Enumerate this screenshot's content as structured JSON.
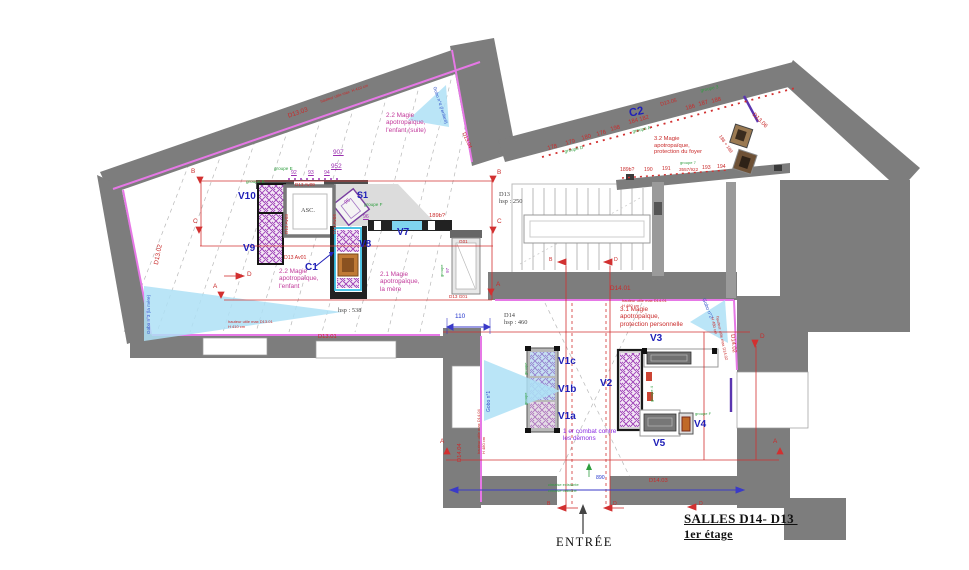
{
  "colors": {
    "wall_gray": "#7d7d7d",
    "light_wall_gray": "#9a9a9a",
    "cimaise_pink": "#e678e6",
    "cimaise_purple": "#5a35b0",
    "annotation_red": "#c92a2a",
    "theme_magenta": "#c2399b",
    "object_purple": "#9b30b0",
    "vitrine_blue": "#2020b8",
    "group_green": "#2e9e3e",
    "gobo_lightblue": "#aee0f6",
    "dimension_blue": "#2233cc"
  },
  "icons": {
    "entrance_arrow": "up-arrow-icon",
    "section_markers": "red-section-arrow-icons",
    "gobos": "light-projection-triangle-icons"
  },
  "annotations": [
    {
      "n": "wall-id-d13-03",
      "t": "D13.03",
      "x": 287,
      "y": 113,
      "c": "red s6",
      "r": -19
    },
    {
      "n": "wall-note-d13-03",
      "t": "hauteur utile max  H 410 cm",
      "x": 320,
      "y": 100,
      "c": "red s3",
      "r": -19
    },
    {
      "n": "gobo4-label",
      "t": "Gobo n°4 (l'enfant)",
      "x": 437,
      "y": 86,
      "c": "blu s4",
      "r": 72
    },
    {
      "n": "wall-id-d13-04",
      "t": "D13.04",
      "x": 465,
      "y": 132,
      "c": "red s5",
      "r": 66
    },
    {
      "n": "theme-2-2-suite",
      "t": "2.2 Magie\napotropaïque,\nl'enfant (suite)",
      "x": 386,
      "y": 112,
      "c": "mag s6"
    },
    {
      "n": "object-num-907",
      "t": "907",
      "x": 333,
      "y": 149,
      "c": "pur s6 u"
    },
    {
      "n": "object-num-952",
      "t": "952",
      "x": 331,
      "y": 163,
      "c": "pur s6 u"
    },
    {
      "n": "object-num-92",
      "t": "92",
      "x": 291,
      "y": 171,
      "c": "pur s5 u"
    },
    {
      "n": "object-num-93",
      "t": "93",
      "x": 308,
      "y": 171,
      "c": "pur s5 u"
    },
    {
      "n": "object-num-94",
      "t": "94",
      "x": 324,
      "y": 171,
      "c": "pur s5 u"
    },
    {
      "n": "group-label-e",
      "t": "groupe E",
      "x": 274,
      "y": 166,
      "c": "grn s4"
    },
    {
      "n": "group-label-b",
      "t": "groupe B",
      "x": 246,
      "y": 179,
      "c": "grn s4"
    },
    {
      "n": "vitrine-v10",
      "t": "V10",
      "x": 238,
      "y": 191,
      "c": "vb s10"
    },
    {
      "n": "wall-id-d13-av09",
      "t": "D13 Av09",
      "x": 295,
      "y": 182,
      "c": "red s4"
    },
    {
      "n": "wall-id-d13-av03",
      "t": "D13 Av03",
      "x": 284,
      "y": 234,
      "c": "red s4",
      "r": -90
    },
    {
      "n": "wall-id-d13-av04",
      "t": "D13 Av04",
      "x": 332,
      "y": 234,
      "c": "red s4",
      "r": -90
    },
    {
      "n": "elevator-label",
      "t": "ASC.",
      "x": 301,
      "y": 207,
      "c": "dim s6"
    },
    {
      "n": "vitrine-s1",
      "t": "S1",
      "x": 357,
      "y": 190,
      "c": "vb s9"
    },
    {
      "n": "object-num-95",
      "t": "95",
      "x": 344,
      "y": 202,
      "c": "pur s5",
      "r": -40
    },
    {
      "n": "group-label-f1",
      "t": "groupe F",
      "x": 364,
      "y": 202,
      "c": "grn s4"
    },
    {
      "n": "object-num-96",
      "t": "96",
      "x": 363,
      "y": 215,
      "c": "pur s5 u"
    },
    {
      "n": "object-num-189b-left",
      "t": "189b?",
      "x": 429,
      "y": 213,
      "c": "red s55"
    },
    {
      "n": "vitrine-v7",
      "t": "V7",
      "x": 397,
      "y": 227,
      "c": "vb s10"
    },
    {
      "n": "vitrine-v8",
      "t": "V8",
      "x": 359,
      "y": 239,
      "c": "vb s10"
    },
    {
      "n": "vitrine-c1",
      "t": "C1",
      "x": 305,
      "y": 262,
      "c": "vb s10"
    },
    {
      "n": "vitrine-v9",
      "t": "V9",
      "x": 243,
      "y": 243,
      "c": "vb s10"
    },
    {
      "n": "wall-id-d13-av01",
      "t": "D13 Av01",
      "x": 284,
      "y": 256,
      "c": "red s5"
    },
    {
      "n": "theme-2-2",
      "t": "2.2 Magie\napotropaïque,\nl'enfant",
      "x": 279,
      "y": 268,
      "c": "mag s6"
    },
    {
      "n": "theme-2-1",
      "t": "2.1 Magie\napotropaïque,\nla mère",
      "x": 380,
      "y": 271,
      "c": "mag s6"
    },
    {
      "n": "wall-id-d13-02",
      "t": "D13.02",
      "x": 153,
      "y": 264,
      "c": "red s6",
      "r": -79
    },
    {
      "n": "gobo3-label",
      "t": "Gobo n°3 (la mère)",
      "x": 146,
      "y": 334,
      "c": "blu s4",
      "r": -90
    },
    {
      "n": "wall-note-d13-01",
      "t": "hauteur utile max D13.01\nH 410 cm",
      "x": 228,
      "y": 320,
      "c": "red s3"
    },
    {
      "n": "wall-id-d13-01",
      "t": "D13.01",
      "x": 318,
      "y": 334,
      "c": "red s55"
    },
    {
      "n": "dim-hsp-538",
      "t": "hsp : 538",
      "x": 338,
      "y": 307,
      "c": "dim s6"
    },
    {
      "n": "vitrine-g01-tag",
      "t": "G01",
      "x": 459,
      "y": 239,
      "c": "red s4"
    },
    {
      "n": "wall-id-d13-g01",
      "t": "D13 G01",
      "x": 449,
      "y": 294,
      "c": "red s4"
    },
    {
      "n": "object-num-97",
      "t": "97",
      "x": 445,
      "y": 273,
      "c": "pur s4",
      "r": -90
    },
    {
      "n": "group-label-g01",
      "t": "groupe",
      "x": 440,
      "y": 277,
      "c": "grn s3",
      "r": -90
    },
    {
      "n": "section-b-left",
      "t": "B",
      "x": 191,
      "y": 168,
      "c": "red s6"
    },
    {
      "n": "section-b-right",
      "t": "B",
      "x": 497,
      "y": 169,
      "c": "red s6"
    },
    {
      "n": "section-c-left",
      "t": "C",
      "x": 193,
      "y": 218,
      "c": "red s6"
    },
    {
      "n": "section-c-right",
      "t": "C",
      "x": 497,
      "y": 218,
      "c": "red s6"
    },
    {
      "n": "section-a-left",
      "t": "A",
      "x": 213,
      "y": 283,
      "c": "red s6"
    },
    {
      "n": "section-a-right",
      "t": "A",
      "x": 496,
      "y": 281,
      "c": "red s6"
    },
    {
      "n": "section-d-mid",
      "t": "D",
      "x": 247,
      "y": 271,
      "c": "red s6"
    },
    {
      "n": "room-c2",
      "t": "C2",
      "x": 628,
      "y": 108,
      "c": "vb s11",
      "r": -12
    },
    {
      "n": "object-num-178",
      "t": "178",
      "x": 547,
      "y": 146,
      "c": "red s55",
      "r": -15
    },
    {
      "n": "object-num-179",
      "t": "179",
      "x": 565,
      "y": 141,
      "c": "red s55",
      "r": -15
    },
    {
      "n": "object-num-180",
      "t": "180",
      "x": 581,
      "y": 136,
      "c": "red s55",
      "r": -15
    },
    {
      "n": "object-num-176",
      "t": "176",
      "x": 596,
      "y": 132,
      "c": "red s55",
      "r": -15
    },
    {
      "n": "object-num-198",
      "t": "198",
      "x": 610,
      "y": 127,
      "c": "red s55",
      "r": -15
    },
    {
      "n": "object-num-184-182",
      "t": "184 182",
      "x": 628,
      "y": 120,
      "c": "red s55",
      "r": -15
    },
    {
      "n": "wall-id-d13-05",
      "t": "D13.05",
      "x": 660,
      "y": 103,
      "c": "red s5",
      "r": -15
    },
    {
      "n": "object-num-186",
      "t": "186",
      "x": 685,
      "y": 106,
      "c": "red s55",
      "r": -15
    },
    {
      "n": "object-num-187",
      "t": "187",
      "x": 698,
      "y": 102,
      "c": "red s55",
      "r": -15
    },
    {
      "n": "object-num-188",
      "t": "188",
      "x": 711,
      "y": 99,
      "c": "red s55",
      "r": -15
    },
    {
      "n": "group-label-d",
      "t": "groupe D",
      "x": 564,
      "y": 149,
      "c": "grn s4",
      "r": -13
    },
    {
      "n": "group-label-a",
      "t": "groupe A",
      "x": 632,
      "y": 129,
      "c": "grn s4",
      "r": -13
    },
    {
      "n": "group-label-3",
      "t": "groupe 3",
      "x": 700,
      "y": 88,
      "c": "grn s4",
      "r": -12
    },
    {
      "n": "theme-3-2",
      "t": "3.2 Magie\napotropaïque,\nprotection du foyer",
      "x": 654,
      "y": 136,
      "c": "red s55"
    },
    {
      "n": "object-num-189b",
      "t": "189b?",
      "x": 620,
      "y": 168,
      "c": "red s5"
    },
    {
      "n": "object-num-190",
      "t": "190",
      "x": 644,
      "y": 168,
      "c": "red s5"
    },
    {
      "n": "object-num-191",
      "t": "191",
      "x": 662,
      "y": 167,
      "c": "red s5"
    },
    {
      "n": "object-num-3557-922",
      "t": "3557/922",
      "x": 679,
      "y": 167,
      "c": "red s4"
    },
    {
      "n": "object-num-193",
      "t": "193",
      "x": 702,
      "y": 166,
      "c": "red s5"
    },
    {
      "n": "object-num-194",
      "t": "194",
      "x": 717,
      "y": 165,
      "c": "red s5"
    },
    {
      "n": "group-label-7",
      "t": "groupe 7",
      "x": 680,
      "y": 161,
      "c": "grn s3"
    },
    {
      "n": "object-num-188-189",
      "t": "188 + 189",
      "x": 722,
      "y": 134,
      "c": "red s4",
      "r": 55
    },
    {
      "n": "wall-id-d13-06",
      "t": "D13.06",
      "x": 755,
      "y": 112,
      "c": "red s55",
      "r": 45
    },
    {
      "n": "room-d13-stairs",
      "t": "D13\nhsp : 250",
      "x": 499,
      "y": 191,
      "c": "dim s6"
    },
    {
      "n": "section-b-stairs",
      "t": "B",
      "x": 549,
      "y": 258,
      "c": "red s5"
    },
    {
      "n": "section-d-stairs",
      "t": "D",
      "x": 614,
      "y": 258,
      "c": "red s5"
    },
    {
      "n": "wall-id-d14-01",
      "t": "D14.01",
      "x": 610,
      "y": 285,
      "c": "red s6"
    },
    {
      "n": "wall-note-d14-01",
      "t": "hauteur utile max D14.01\nH 480 cm",
      "x": 622,
      "y": 299,
      "c": "red s3"
    },
    {
      "n": "room-d14",
      "t": "D14\nhsp : 460",
      "x": 504,
      "y": 312,
      "c": "dim s6"
    },
    {
      "n": "dim-110",
      "t": "110",
      "x": 455,
      "y": 313,
      "c": "bl2 s6"
    },
    {
      "n": "gobo1-label",
      "t": "Gobo n°1",
      "x": 487,
      "y": 412,
      "c": "blu s45",
      "r": -90
    },
    {
      "n": "wall-id-d14-04",
      "t": "D14.04",
      "x": 457,
      "y": 462,
      "c": "red s55",
      "r": -90
    },
    {
      "n": "wall-note-d14-04",
      "t": "hauteur utile max D14.04\nH 480 cm",
      "x": 477,
      "y": 454,
      "c": "red s3",
      "r": -90
    },
    {
      "n": "theme-3-1",
      "t": "3.1 Magie\napotropaïque,\nprotection personnelle",
      "x": 620,
      "y": 306,
      "c": "red s6"
    },
    {
      "n": "gobo2-label",
      "t": "Gobo n°2",
      "x": 705,
      "y": 298,
      "c": "blu s45",
      "r": 68
    },
    {
      "n": "wall-note-d14-02",
      "t": "hauteur utile max D14.02\nH 480 cm",
      "x": 719,
      "y": 316,
      "c": "red s3",
      "r": 78
    },
    {
      "n": "wall-id-d14-02",
      "t": "D14.02",
      "x": 735,
      "y": 334,
      "c": "red s55",
      "r": 84
    },
    {
      "n": "section-d-upper-right",
      "t": "D",
      "x": 760,
      "y": 333,
      "c": "red s6"
    },
    {
      "n": "vitrine-v1c",
      "t": "V1c",
      "x": 558,
      "y": 356,
      "c": "vb s10"
    },
    {
      "n": "vitrine-v1b",
      "t": "V1b",
      "x": 558,
      "y": 384,
      "c": "vb s10"
    },
    {
      "n": "vitrine-v1a",
      "t": "V1a",
      "x": 558,
      "y": 411,
      "c": "vb s10"
    },
    {
      "n": "vitrine-v2",
      "t": "V2",
      "x": 600,
      "y": 378,
      "c": "vb s10"
    },
    {
      "n": "vitrine-v3",
      "t": "V3",
      "x": 650,
      "y": 333,
      "c": "vb s10"
    },
    {
      "n": "vitrine-v4",
      "t": "V4",
      "x": 694,
      "y": 419,
      "c": "vb s10"
    },
    {
      "n": "vitrine-v5",
      "t": "V5",
      "x": 653,
      "y": 438,
      "c": "vb s10"
    },
    {
      "n": "note-combat",
      "t": "1 er combat contre\nles démons",
      "x": 563,
      "y": 428,
      "c": "vio s6"
    },
    {
      "n": "group-label-v1c",
      "t": "groupe",
      "x": 524,
      "y": 375,
      "c": "grn s3",
      "r": -90
    },
    {
      "n": "group-label-v1b",
      "t": "groupe",
      "x": 524,
      "y": 405,
      "c": "grn s3",
      "r": -90
    },
    {
      "n": "group-label-v2",
      "t": "groupe 4",
      "x": 650,
      "y": 402,
      "c": "grn s3",
      "r": -90
    },
    {
      "n": "group-label-f2",
      "t": "groupe F",
      "x": 695,
      "y": 412,
      "c": "grn s3"
    },
    {
      "n": "section-a-lower-left",
      "t": "A",
      "x": 440,
      "y": 438,
      "c": "red s6"
    },
    {
      "n": "section-a-lower-right",
      "t": "A",
      "x": 773,
      "y": 438,
      "c": "red s6"
    },
    {
      "n": "wall-id-d14-03",
      "t": "D14.03",
      "x": 649,
      "y": 478,
      "c": "red s55"
    },
    {
      "n": "dim-890",
      "t": "890",
      "x": 596,
      "y": 476,
      "c": "bl2 s5"
    },
    {
      "n": "note-cimaise-1",
      "t": "cimaise existante",
      "x": 548,
      "y": 483,
      "c": "grn s3"
    },
    {
      "n": "note-cimaise-2",
      "t": "cimaise blanche",
      "x": 548,
      "y": 489,
      "c": "grn s3"
    },
    {
      "n": "section-b-entrance",
      "t": "B",
      "x": 547,
      "y": 502,
      "c": "red s5"
    },
    {
      "n": "section-d-entrance",
      "t": "D",
      "x": 613,
      "y": 502,
      "c": "red s5"
    },
    {
      "n": "section-d-bottom-right",
      "t": "D",
      "x": 699,
      "y": 502,
      "c": "red s5"
    },
    {
      "n": "entrance-label",
      "t": "ENTRÉE",
      "x": 556,
      "y": 535,
      "c": "entree"
    },
    {
      "n": "drawing-title-line1",
      "t": "SALLES D14- D13 ",
      "x": 684,
      "y": 512,
      "c": "title"
    },
    {
      "n": "drawing-title-line2",
      "t": "1er étage",
      "x": 684,
      "y": 528,
      "c": "title t2"
    }
  ]
}
